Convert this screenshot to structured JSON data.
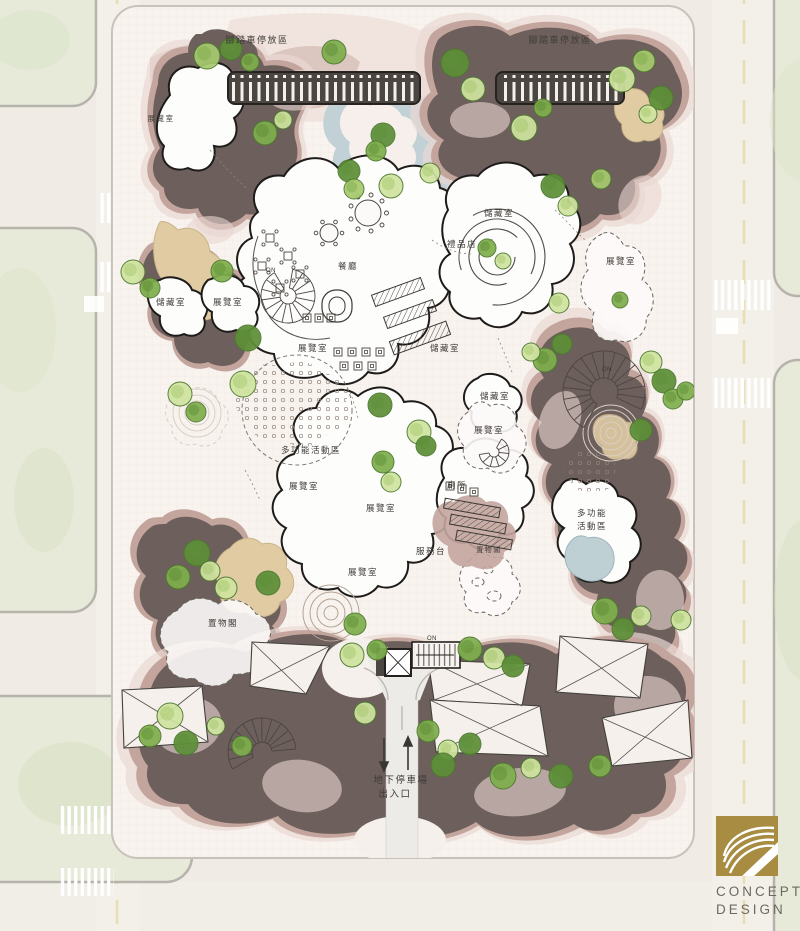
{
  "plan": {
    "logo": {
      "line1": "CONCEPT",
      "line2": "DESIGN",
      "gold": "#a88c41"
    },
    "colors": {
      "site_bg": "#f9f3ef",
      "dark_terrain": "#6d5f5c",
      "mauve_terrain": "#c3a59d",
      "light_pink": "#ead9d3",
      "sand": "#e0cba3",
      "water": "#c2d1d6",
      "road": "#f3f0ea",
      "block_green": "#e7ead9",
      "tree_greens": [
        "#cfe3a0",
        "#a6c96e",
        "#7fae4d",
        "#5d8f38"
      ],
      "tree_stroke": "#4c7a2e",
      "label_ink": "#403c38"
    },
    "map_labels": [
      {
        "text": "腳踏車停放區",
        "x": 257,
        "y": 43,
        "fs": 9
      },
      {
        "text": "腳踏車停放區",
        "x": 560,
        "y": 43,
        "fs": 9
      },
      {
        "text": "展覽室",
        "x": 161,
        "y": 121,
        "fs": 7.5
      },
      {
        "text": "儲藏室",
        "x": 171,
        "y": 305
      },
      {
        "text": "展覽室",
        "x": 228,
        "y": 305
      },
      {
        "text": "展覽室",
        "x": 313,
        "y": 351
      },
      {
        "text": "餐廳",
        "x": 348,
        "y": 269
      },
      {
        "text": "儲藏室",
        "x": 499,
        "y": 216
      },
      {
        "text": "禮品店",
        "x": 462,
        "y": 247
      },
      {
        "text": "展覽室",
        "x": 621,
        "y": 264
      },
      {
        "text": "儲藏室",
        "x": 445,
        "y": 351
      },
      {
        "text": "儲藏室",
        "x": 495,
        "y": 399
      },
      {
        "text": "展覽室",
        "x": 489,
        "y": 433
      },
      {
        "text": "多功能活動區",
        "x": 311,
        "y": 453
      },
      {
        "text": "展覽室",
        "x": 304,
        "y": 489
      },
      {
        "text": "展覽室",
        "x": 381,
        "y": 511
      },
      {
        "text": "廁所",
        "x": 457,
        "y": 488
      },
      {
        "text": "服務台",
        "x": 431,
        "y": 554
      },
      {
        "text": "置物閣",
        "x": 489,
        "y": 552,
        "fs": 7
      },
      {
        "text": "展覽室",
        "x": 363,
        "y": 575
      },
      {
        "text": "多功能",
        "x": 592,
        "y": 516
      },
      {
        "text": "活動區",
        "x": 592,
        "y": 529
      },
      {
        "text": "置物閣",
        "x": 223,
        "y": 626
      },
      {
        "text": "地下停車場",
        "x": 401,
        "y": 783,
        "fs": 9.5
      },
      {
        "text": "出入口",
        "x": 395,
        "y": 797,
        "fs": 9.5
      },
      {
        "text": "ON",
        "x": 271,
        "y": 272,
        "fs": 6,
        "on": true
      },
      {
        "text": "ON",
        "x": 607,
        "y": 371,
        "fs": 6,
        "on": true
      },
      {
        "text": "ON",
        "x": 432,
        "y": 640,
        "fs": 6,
        "on": true
      }
    ],
    "trees": [
      {
        "x": 207,
        "y": 56,
        "r": 13,
        "s": 1
      },
      {
        "x": 231,
        "y": 49,
        "r": 11,
        "s": 3
      },
      {
        "x": 250,
        "y": 62,
        "r": 9,
        "s": 2
      },
      {
        "x": 334,
        "y": 52,
        "r": 12,
        "s": 2
      },
      {
        "x": 455,
        "y": 63,
        "r": 14,
        "s": 3
      },
      {
        "x": 473,
        "y": 89,
        "r": 12,
        "s": 0
      },
      {
        "x": 524,
        "y": 128,
        "r": 13,
        "s": 0
      },
      {
        "x": 543,
        "y": 108,
        "r": 9,
        "s": 2
      },
      {
        "x": 622,
        "y": 79,
        "r": 13,
        "s": 0
      },
      {
        "x": 644,
        "y": 61,
        "r": 11,
        "s": 1
      },
      {
        "x": 661,
        "y": 98,
        "r": 12,
        "s": 3
      },
      {
        "x": 648,
        "y": 114,
        "r": 9,
        "s": 0
      },
      {
        "x": 601,
        "y": 179,
        "r": 10,
        "s": 1
      },
      {
        "x": 553,
        "y": 186,
        "r": 12,
        "s": 3
      },
      {
        "x": 568,
        "y": 206,
        "r": 10,
        "s": 0
      },
      {
        "x": 265,
        "y": 133,
        "r": 12,
        "s": 2
      },
      {
        "x": 283,
        "y": 120,
        "r": 9,
        "s": 0
      },
      {
        "x": 383,
        "y": 135,
        "r": 12,
        "s": 3
      },
      {
        "x": 376,
        "y": 151,
        "r": 10,
        "s": 2
      },
      {
        "x": 349,
        "y": 171,
        "r": 11,
        "s": 3
      },
      {
        "x": 391,
        "y": 186,
        "r": 12,
        "s": 0
      },
      {
        "x": 354,
        "y": 189,
        "r": 10,
        "s": 1
      },
      {
        "x": 430,
        "y": 173,
        "r": 10,
        "s": 0
      },
      {
        "x": 133,
        "y": 272,
        "r": 12,
        "s": 0
      },
      {
        "x": 150,
        "y": 288,
        "r": 10,
        "s": 2
      },
      {
        "x": 222,
        "y": 271,
        "r": 11,
        "s": 2
      },
      {
        "x": 248,
        "y": 338,
        "r": 13,
        "s": 3
      },
      {
        "x": 180,
        "y": 394,
        "r": 12,
        "s": 0
      },
      {
        "x": 196,
        "y": 412,
        "r": 10,
        "s": 2
      },
      {
        "x": 243,
        "y": 384,
        "r": 13,
        "s": 0
      },
      {
        "x": 380,
        "y": 405,
        "r": 12,
        "s": 3
      },
      {
        "x": 383,
        "y": 462,
        "r": 11,
        "s": 2
      },
      {
        "x": 391,
        "y": 482,
        "r": 10,
        "s": 0
      },
      {
        "x": 419,
        "y": 432,
        "r": 12,
        "s": 0
      },
      {
        "x": 426,
        "y": 446,
        "r": 10,
        "s": 3
      },
      {
        "x": 487,
        "y": 248,
        "r": 9,
        "s": 2
      },
      {
        "x": 503,
        "y": 261,
        "r": 8,
        "s": 0
      },
      {
        "x": 545,
        "y": 360,
        "r": 12,
        "s": 2
      },
      {
        "x": 531,
        "y": 352,
        "r": 9,
        "s": 0
      },
      {
        "x": 562,
        "y": 344,
        "r": 10,
        "s": 3
      },
      {
        "x": 651,
        "y": 362,
        "r": 11,
        "s": 0
      },
      {
        "x": 664,
        "y": 381,
        "r": 12,
        "s": 3
      },
      {
        "x": 673,
        "y": 399,
        "r": 10,
        "s": 2
      },
      {
        "x": 641,
        "y": 430,
        "r": 11,
        "s": 3
      },
      {
        "x": 620,
        "y": 300,
        "r": 8,
        "s": 2
      },
      {
        "x": 559,
        "y": 303,
        "r": 10,
        "s": 0
      },
      {
        "x": 686,
        "y": 391,
        "r": 9,
        "s": 2
      },
      {
        "x": 197,
        "y": 553,
        "r": 13,
        "s": 3
      },
      {
        "x": 178,
        "y": 577,
        "r": 12,
        "s": 2
      },
      {
        "x": 210,
        "y": 571,
        "r": 10,
        "s": 0
      },
      {
        "x": 226,
        "y": 588,
        "r": 11,
        "s": 0
      },
      {
        "x": 268,
        "y": 583,
        "r": 12,
        "s": 3
      },
      {
        "x": 355,
        "y": 624,
        "r": 11,
        "s": 2
      },
      {
        "x": 352,
        "y": 655,
        "r": 12,
        "s": 0
      },
      {
        "x": 377,
        "y": 650,
        "r": 10,
        "s": 2
      },
      {
        "x": 470,
        "y": 649,
        "r": 12,
        "s": 2
      },
      {
        "x": 494,
        "y": 658,
        "r": 11,
        "s": 0
      },
      {
        "x": 513,
        "y": 666,
        "r": 11,
        "s": 3
      },
      {
        "x": 605,
        "y": 611,
        "r": 13,
        "s": 2
      },
      {
        "x": 623,
        "y": 629,
        "r": 11,
        "s": 3
      },
      {
        "x": 641,
        "y": 616,
        "r": 10,
        "s": 0
      },
      {
        "x": 170,
        "y": 716,
        "r": 13,
        "s": 0
      },
      {
        "x": 150,
        "y": 736,
        "r": 11,
        "s": 2
      },
      {
        "x": 186,
        "y": 743,
        "r": 12,
        "s": 3
      },
      {
        "x": 216,
        "y": 726,
        "r": 9,
        "s": 0
      },
      {
        "x": 242,
        "y": 746,
        "r": 10,
        "s": 2
      },
      {
        "x": 365,
        "y": 713,
        "r": 11,
        "s": 0
      },
      {
        "x": 428,
        "y": 731,
        "r": 11,
        "s": 2
      },
      {
        "x": 448,
        "y": 750,
        "r": 10,
        "s": 0
      },
      {
        "x": 470,
        "y": 744,
        "r": 11,
        "s": 3
      },
      {
        "x": 443,
        "y": 765,
        "r": 12,
        "s": 3
      },
      {
        "x": 503,
        "y": 776,
        "r": 13,
        "s": 2
      },
      {
        "x": 531,
        "y": 768,
        "r": 10,
        "s": 0
      },
      {
        "x": 561,
        "y": 776,
        "r": 12,
        "s": 3
      },
      {
        "x": 600,
        "y": 766,
        "r": 11,
        "s": 2
      },
      {
        "x": 681,
        "y": 620,
        "r": 10,
        "s": 0
      }
    ]
  }
}
